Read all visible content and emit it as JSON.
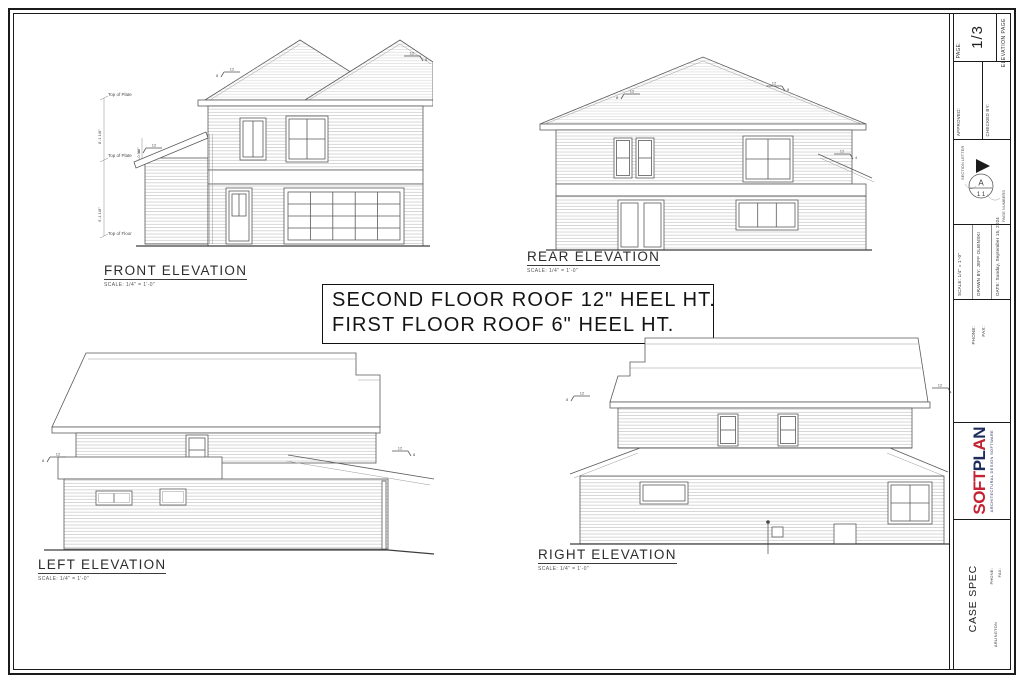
{
  "sheet": {
    "border_color": "#1b1b1b",
    "line_color": "#5a5a5a"
  },
  "note_box": {
    "line1": "SECOND FLOOR ROOF 12\" HEEL HT.",
    "line2": "FIRST FLOOR ROOF 6\" HEEL HT."
  },
  "elevations": {
    "front": {
      "title": "FRONT ELEVATION",
      "scale": "SCALE: 1/4\" = 1'-0\""
    },
    "rear": {
      "title": "REAR ELEVATION",
      "scale": "SCALE: 1/4\" = 1'-0\""
    },
    "left": {
      "title": "LEFT ELEVATION",
      "scale": "SCALE: 1/4\" = 1'-0\""
    },
    "right": {
      "title": "RIGHT ELEVATION",
      "scale": "SCALE: 1/4\" = 1'-0\""
    }
  },
  "annotations": {
    "top_of_plate": "Top of Plate",
    "top_of_floor": "Top of Floor",
    "second_floor_height": "8'-1 1/8\"",
    "first_floor_height": "9'-1 1/8\"",
    "heel_height": "1'-0 5/8\"",
    "pitch_run": "12",
    "pitch_rise_main": "8",
    "pitch_rise_low": "4"
  },
  "title_block": {
    "page_label": "PAGE:",
    "page_number": "1/3",
    "page_type": "ELEVATION PAGE",
    "approved_label": "APPROVED:",
    "checked_by_label": "CHECKED BY:",
    "section_symbol": {
      "letter": "A",
      "numbers": "1 1",
      "section_letter_label": "SECTION LETTER",
      "page_numbers_label": "PAGE NUMBERS"
    },
    "scale": "SCALE:  1/4\" = 1'-0\"",
    "drawn_by": "DRAWN BY:  JEFF OLBINSKI",
    "date": "DATE:  Sunday, September 15, 2024",
    "phone_label": "PHONE:",
    "fax_label": "FAX:",
    "logo": {
      "soft": "SOFT",
      "pl": "PL",
      "a": "A",
      "n": "N",
      "tagline": "ARCHITECTURAL DESIGN SOFTWARE",
      "red": "#c52333",
      "navy": "#1d2c5c"
    },
    "project_name": "CASE SPEC",
    "project_phone_label": "PHONE:",
    "project_fax_label": "FAX:",
    "project_location": "ARLINGTON"
  }
}
